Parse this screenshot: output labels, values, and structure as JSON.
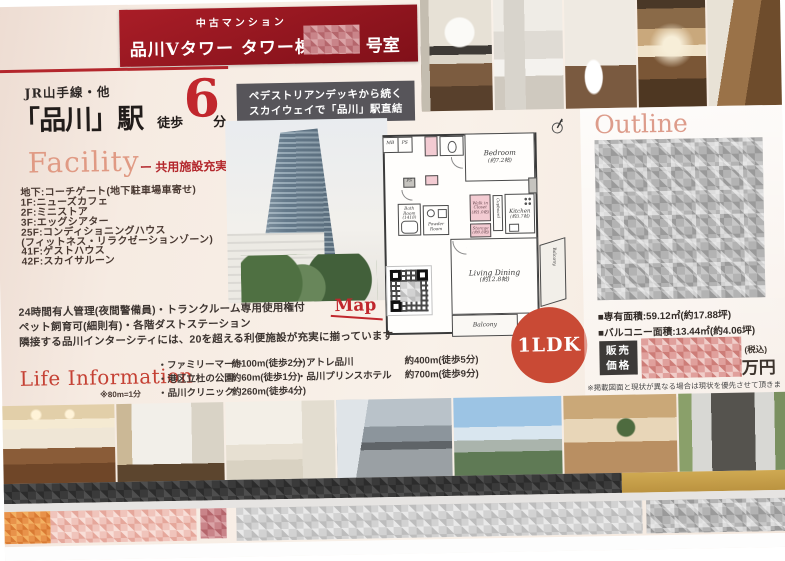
{
  "colors": {
    "brand_red": "#9a1722",
    "accent_red": "#c0272d",
    "salmon_heading": "#e09a84",
    "badge_red": "#c94a35",
    "gold_bar": "#c9a24e",
    "deck_box_gray": "#57555a"
  },
  "header": {
    "category": "中古マンション",
    "title": "品川Ⅴタワー タワー棟",
    "room_suffix": "号室"
  },
  "access": {
    "line": "JR山手線・他",
    "station": "「品川」駅",
    "walk": "徒歩",
    "minutes": "6",
    "unit": "分",
    "deck_line1": "ペデストリアンデッキから続く",
    "deck_line2": "スカイウェイで「品川」駅直結"
  },
  "facility": {
    "title": "Facility",
    "subtitle": "ー 共用施設充実 ー",
    "items": [
      "地下:コーチゲート(地下駐車場車寄せ)",
      "1F:ニューズカフェ",
      "2F:ミニストア",
      "3F:エッグシアター",
      "25F:コンディショニングハウス",
      "(フィットネス・リラクゼーションゾーン)",
      "41F:ゲストハウス",
      "42F:スカイサルーン"
    ]
  },
  "management": {
    "line1": "24時間有人管理(夜間警備員)・トランクルーム専用使用権付",
    "line2": "ペット飼育可(細則有)・各階ダストステーション",
    "line3": "隣接する品川インターシティには、20を超える利便施設が充実に揃っています",
    "map": "Map"
  },
  "life": {
    "title": "Life Information",
    "note": "※80m=1分",
    "col1": [
      {
        "n": "・ファミリーマート",
        "d": "約100m(徒歩2分)"
      },
      {
        "n": "・港区立杜の公園",
        "d": "約60m(徒歩1分)"
      },
      {
        "n": "・品川クリニック",
        "d": "約260m(徒歩4分)"
      }
    ],
    "col2": [
      {
        "n": "・アトレ品川",
        "d": "約400m(徒歩5分)"
      },
      {
        "n": "・品川プリンスホテル",
        "d": "約700m(徒歩9分)"
      }
    ]
  },
  "badge": {
    "label": "1LDK"
  },
  "outline": {
    "title": "Outline",
    "area1": "■専有面積:59.12㎡(約17.88坪)",
    "area2": "■バルコニー面積:13.44㎡(約4.06坪)",
    "price_l1": "販売",
    "price_l2": "価格",
    "tax": "(税込)",
    "unit": "万円",
    "disclaimer": "※掲載図面と現状が異なる場合は現状を優先させて頂きます。"
  },
  "floorplan": {
    "bedroom": "Bedroom",
    "bedroom_size": "(約7.2帖)",
    "living": "Living Dining",
    "living_size": "(約12.8帖)",
    "kitchen": "Kitchen",
    "kitchen_size": "(約3.7帖)",
    "wic1": "Walk in",
    "wic2": "Closet",
    "wic_size": "(約1.0帖)",
    "storage": "Storage",
    "storage_size": "(約0.8帖)",
    "cupboard": "Cupboard",
    "bath": "Bath Room",
    "bath_size": "(1418)",
    "powder1": "Powder",
    "powder2": "Room",
    "balcony": "Balcony",
    "balcony_side": "Balcony",
    "mb": "MB",
    "ps": "PS",
    "ps2": "PS"
  }
}
